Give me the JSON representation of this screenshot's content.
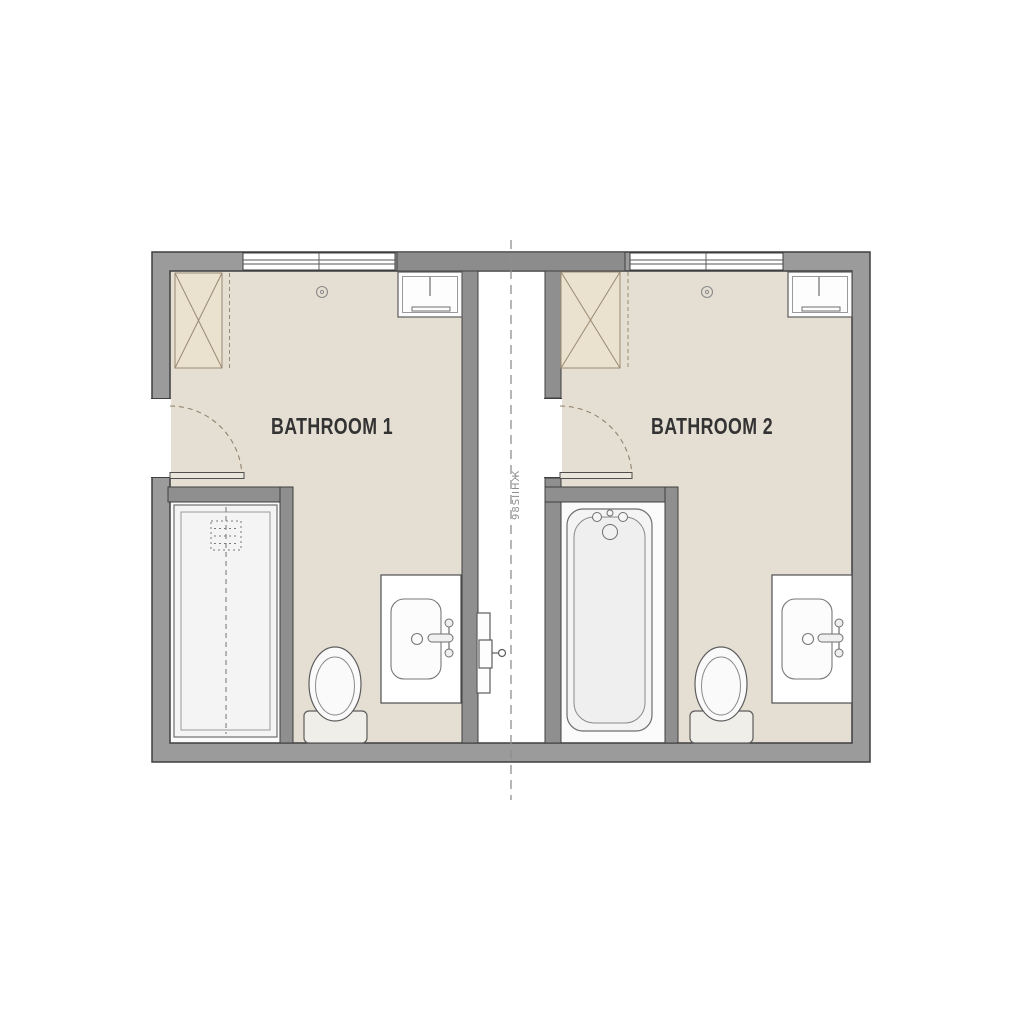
{
  "plan": {
    "type": "floor-plan",
    "rooms": [
      {
        "name": "BATHROOM 1",
        "fixtures": [
          "wardrobe-closet",
          "window",
          "wall-cabinet",
          "ceiling-light",
          "swing-door",
          "shower",
          "toilet",
          "sink-vanity"
        ]
      },
      {
        "name": "BATHROOM 2",
        "fixtures": [
          "wardrobe-closet",
          "window",
          "wall-cabinet",
          "ceiling-light",
          "swing-door",
          "bathtub",
          "toilet",
          "sink-vanity"
        ]
      }
    ],
    "corridor": {
      "centerline_label": "98SIIHЖ",
      "fixtures": [
        "duct-door-with-key"
      ]
    },
    "colors": {
      "wall": "#9b9b9b",
      "wall_dark": "#8c8c8c",
      "outline": "#3f3f3f",
      "floor": "#e5dfd3",
      "closet": "#ebe1cf",
      "closet_stroke": "#9a8a72",
      "fixture_fill": "#f4f4f4",
      "fixture_stroke": "#6e6e6e",
      "label": "#333333",
      "centerline": "#8e8e8e",
      "background": "#ffffff"
    }
  }
}
